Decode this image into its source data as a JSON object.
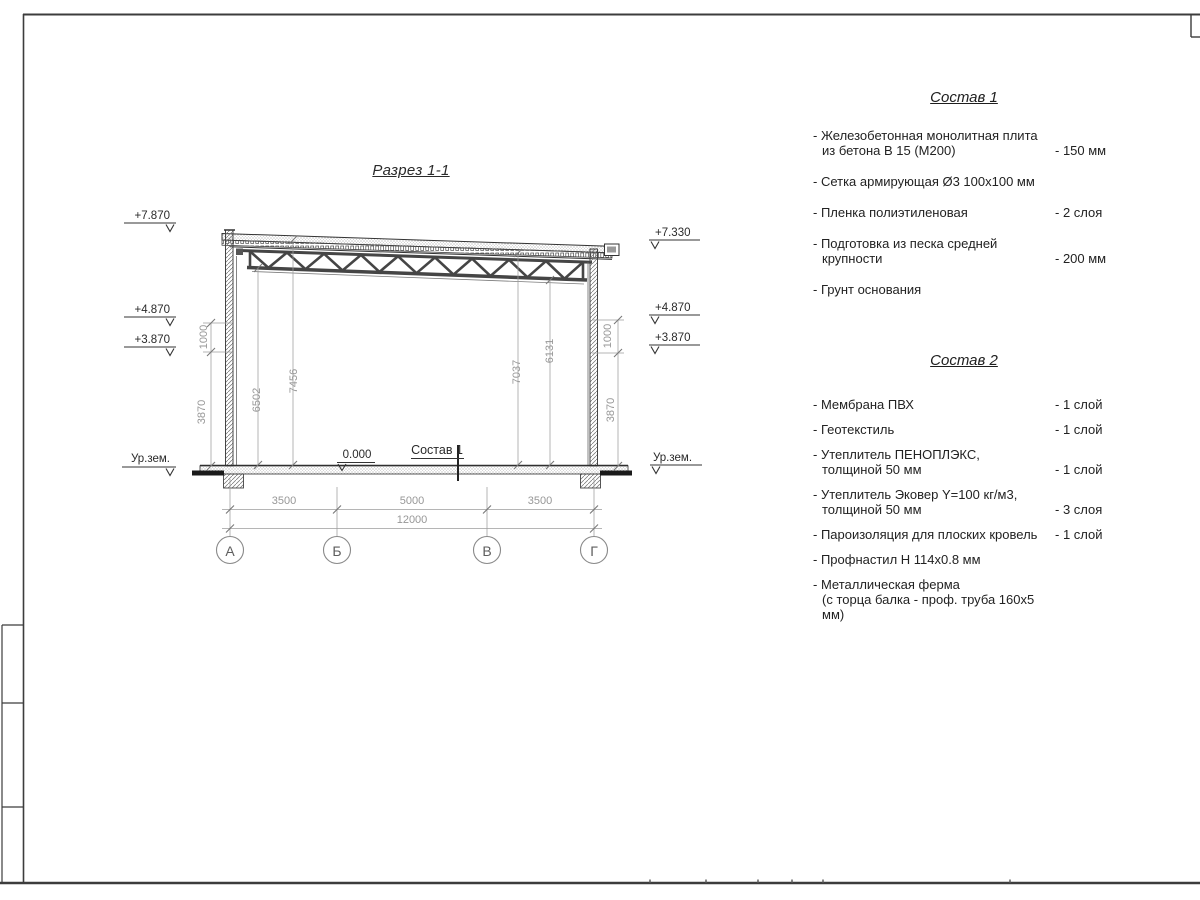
{
  "page": {
    "title": "Разрез 1-1"
  },
  "drawing": {
    "elevation_marks_left": [
      "+7.870",
      "+4.870",
      "+3.870",
      "Ур.зем."
    ],
    "elevation_marks_right": [
      "+7.330",
      "+4.870",
      "+3.870",
      "Ур.зем."
    ],
    "zero_mark": "0.000",
    "floor_label": "Состав 1",
    "inner_dims": {
      "d6502": "6502",
      "d7456": "7456",
      "d7037": "7037",
      "d6131": "6131"
    },
    "wall_dims_left": {
      "top": "1000",
      "bottom": "3870"
    },
    "wall_dims_right": {
      "top": "1000",
      "bottom": "3870"
    },
    "bottom_dims": {
      "s1": "3500",
      "s2": "5000",
      "s3": "3500",
      "total": "12000"
    },
    "axes": [
      "А",
      "Б",
      "В",
      "Г"
    ]
  },
  "sostav1": {
    "title": "Состав 1",
    "items": [
      {
        "text": "- Железобетонная  монолитная плита\nиз бетона В 15 (М200)",
        "value": "- 150 мм"
      },
      {
        "text": "- Сетка армирующая Ø3 100х100 мм",
        "value": ""
      },
      {
        "text": "- Пленка полиэтиленовая",
        "value": "-  2 слоя"
      },
      {
        "text": "- Подготовка из песка средней\nкрупности",
        "value": "- 200 мм"
      },
      {
        "text": "- Грунт основания",
        "value": ""
      }
    ]
  },
  "sostav2": {
    "title": "Состав 2",
    "items": [
      {
        "text": "- Мембрана ПВХ",
        "value": "- 1 слой"
      },
      {
        "text": "- Геотекстиль",
        "value": "- 1 слой"
      },
      {
        "text": "- Утеплитель ПЕНОПЛЭКС,\nтолщиной 50 мм",
        "value": "- 1 слой"
      },
      {
        "text": "- Утеплитель Эковер Y=100 кг/м3,\nтолщиной 50 мм",
        "value": "- 3 слоя"
      },
      {
        "text": "- Пароизоляция для плоских кровель",
        "value": "- 1 слой"
      },
      {
        "text": "- Профнастил Н 114х0.8 мм",
        "value": ""
      },
      {
        "text": "- Металлическая ферма\n(с торца балка - проф. труба 160х5 мм)",
        "value": ""
      }
    ]
  }
}
